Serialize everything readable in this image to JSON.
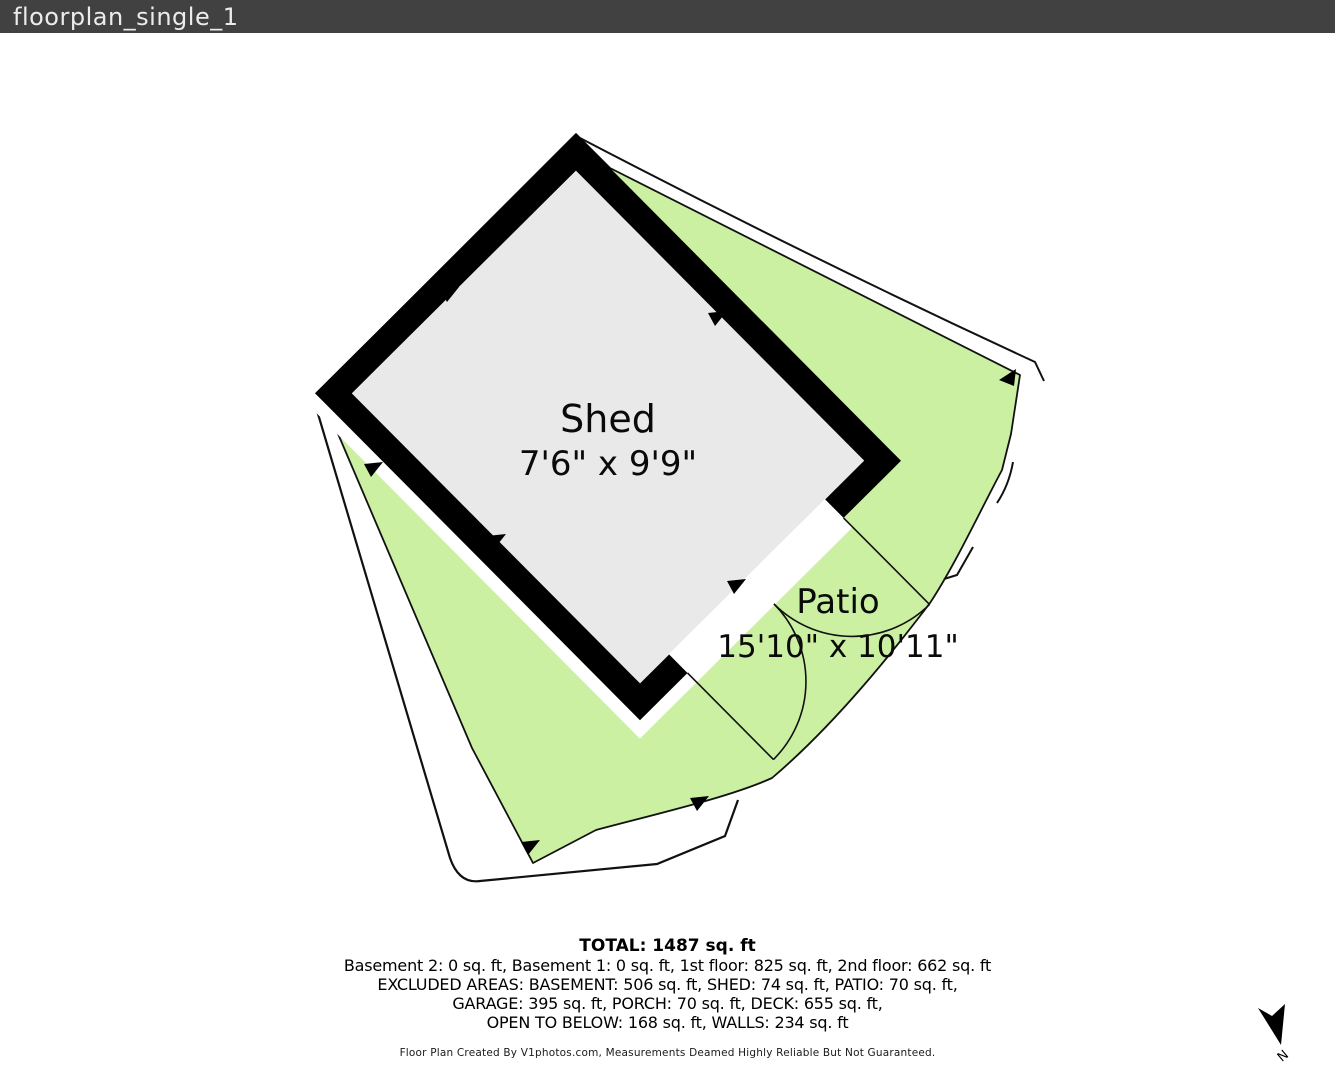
{
  "header": {
    "title": "floorplan_single_1"
  },
  "plan": {
    "shed": {
      "name": "Shed",
      "dims": "7'6\" x 9'9\""
    },
    "patio": {
      "name": "Patio",
      "dims": "15'10\" x 10'11\""
    },
    "colors": {
      "patio_green": "#cbf0a2",
      "shed_gray": "#e9e9e9",
      "wall_black": "#000000",
      "header_gray": "#414141",
      "outline_black": "#111111"
    }
  },
  "summary": {
    "total": "TOTAL: 1487 sq. ft",
    "lines": [
      "Basement 2: 0 sq. ft, Basement 1: 0 sq. ft, 1st floor: 825 sq. ft, 2nd floor: 662 sq. ft",
      "EXCLUDED AREAS: BASEMENT: 506 sq. ft, SHED: 74 sq. ft, PATIO: 70 sq. ft,",
      "GARAGE: 395 sq. ft, PORCH: 70 sq. ft, DECK: 655 sq. ft,",
      "OPEN TO BELOW: 168 sq. ft, WALLS: 234 sq. ft"
    ],
    "disclaimer": "Floor Plan Created By V1photos.com, Measurements Deamed Highly Reliable But Not Guaranteed."
  },
  "compass": {
    "north_label": "N"
  }
}
